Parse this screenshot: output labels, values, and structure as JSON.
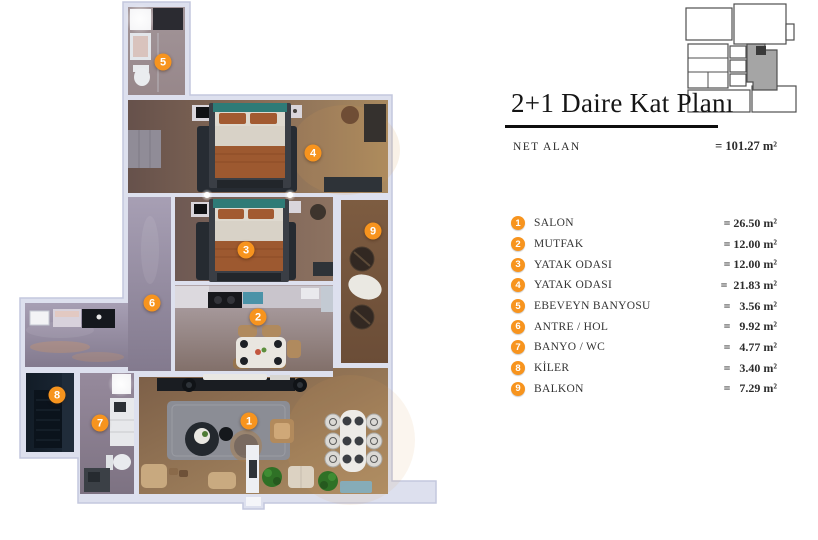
{
  "header": {
    "title": "2+1 Daire Kat Planı",
    "area_label": "NET ALAN",
    "area_value": "= 101.27 m²"
  },
  "legend": [
    {
      "num": "1",
      "label": "SALON",
      "value": "= 26.50 m²"
    },
    {
      "num": "2",
      "label": "MUTFAK",
      "value": "= 12.00 m²"
    },
    {
      "num": "3",
      "label": "YATAK ODASI",
      "value": "= 12.00 m²"
    },
    {
      "num": "4",
      "label": "YATAK ODASI",
      "value": "=  21.83 m²"
    },
    {
      "num": "5",
      "label": "EBEVEYN BANYOSU",
      "value": "=   3.56 m²"
    },
    {
      "num": "6",
      "label": "ANTRE / HOL",
      "value": "=   9.92 m²"
    },
    {
      "num": "7",
      "label": "BANYO / WC",
      "value": "=   4.77 m²"
    },
    {
      "num": "8",
      "label": "KİLER",
      "value": "=   3.40 m²"
    },
    {
      "num": "9",
      "label": "BALKON",
      "value": "=   7.29 m²"
    }
  ],
  "plan_markers": [
    {
      "num": "1"
    },
    {
      "num": "2"
    },
    {
      "num": "3"
    },
    {
      "num": "4"
    },
    {
      "num": "5"
    },
    {
      "num": "6"
    },
    {
      "num": "7"
    },
    {
      "num": "8"
    },
    {
      "num": "9"
    }
  ],
  "colors": {
    "accent_orange": "#f7941e",
    "wall_fill": "#dde0ee",
    "keyplan_highlight": "#a5a5a5",
    "title_text": "#151515",
    "legend_text": "#333333"
  }
}
